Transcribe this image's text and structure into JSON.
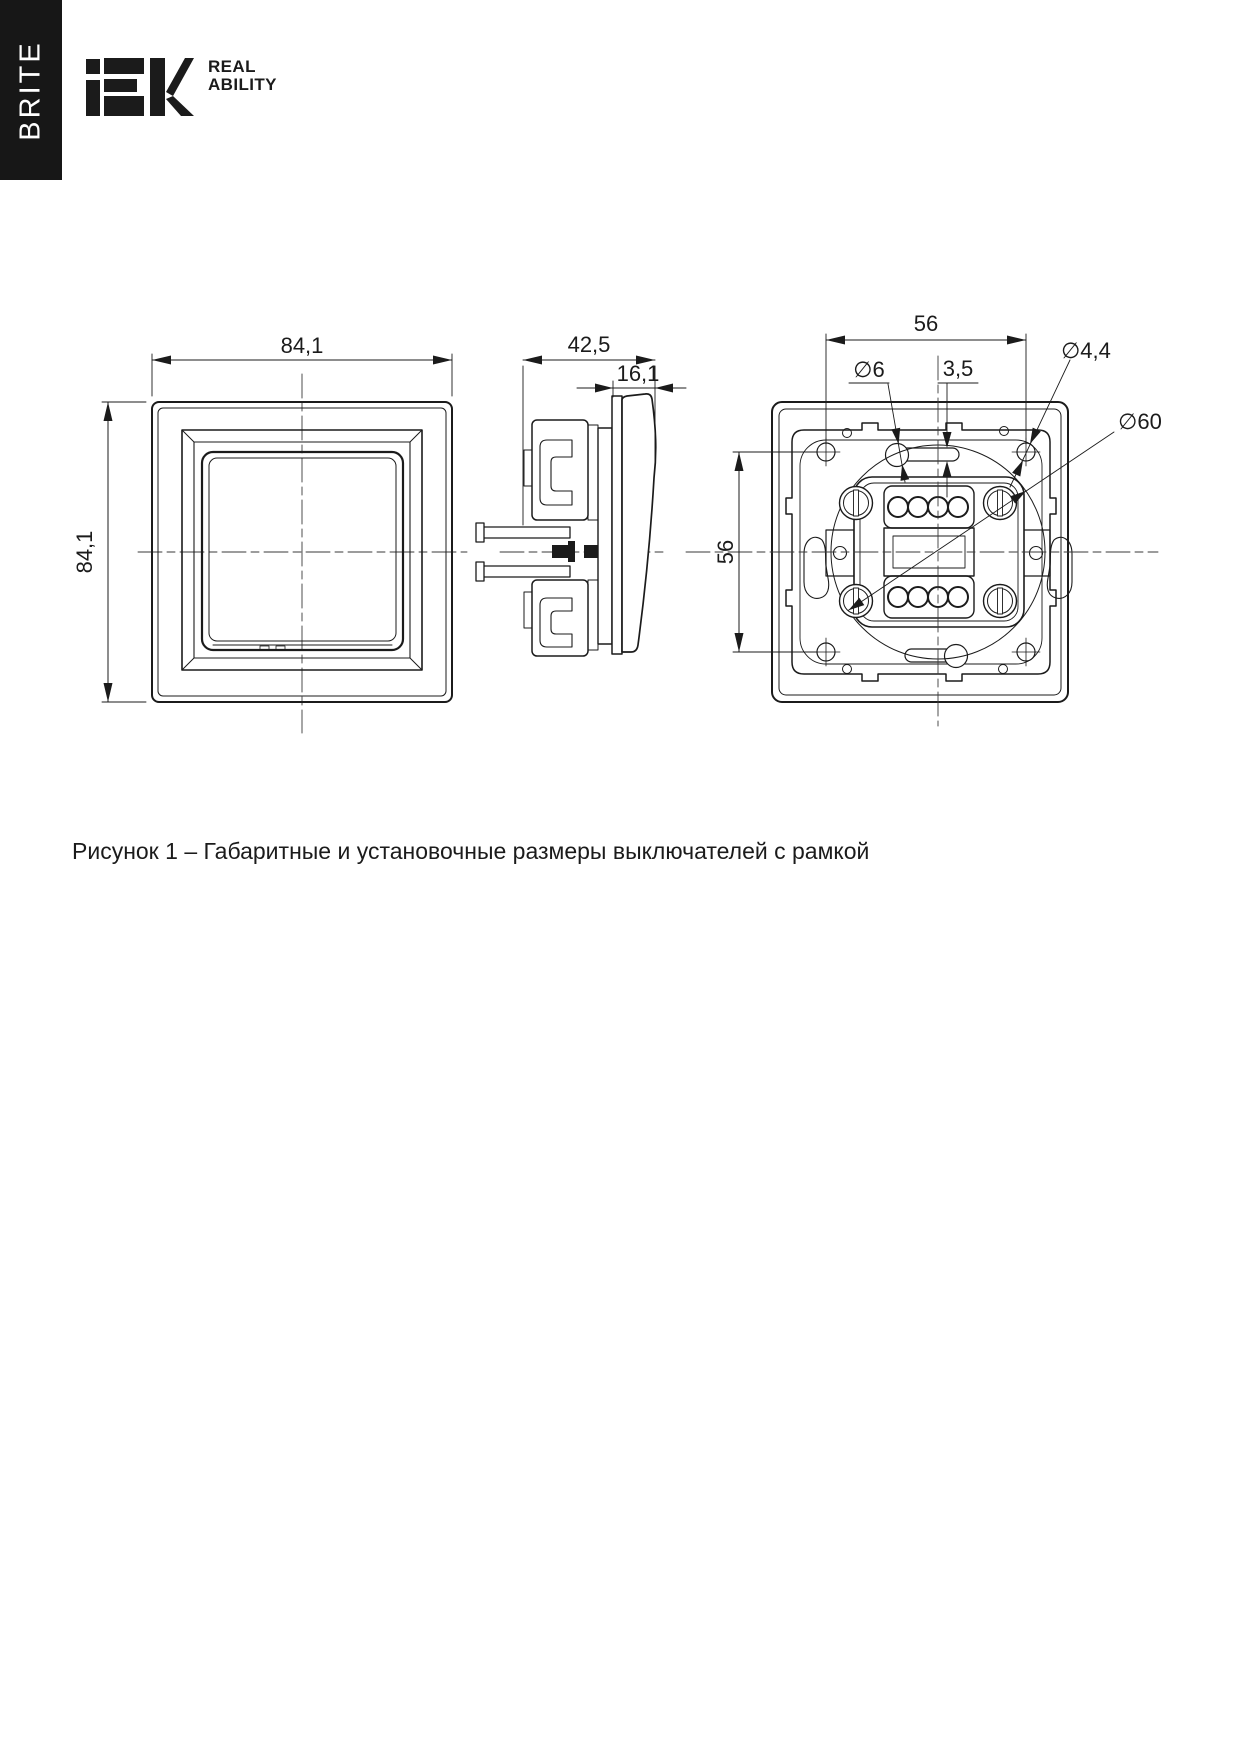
{
  "header": {
    "series_label": "BRITE",
    "logo": "IEK",
    "tagline_line1": "REAL",
    "tagline_line2": "ABILITY"
  },
  "figure": {
    "caption": "Рисунок 1 – Габаритные и установочные размеры выключателей с рамкой",
    "dims": {
      "front_width": "84,1",
      "front_height": "84,1",
      "side_depth": "42,5",
      "side_front_depth": "16,1",
      "back_hole_spacing_h": "56",
      "back_hole_spacing_v": "56",
      "slot_hole_diameter": "∅6",
      "slot_width": "3,5",
      "screw_hole_diameter": "∅4,4",
      "support_ring_diameter": "∅60"
    }
  }
}
